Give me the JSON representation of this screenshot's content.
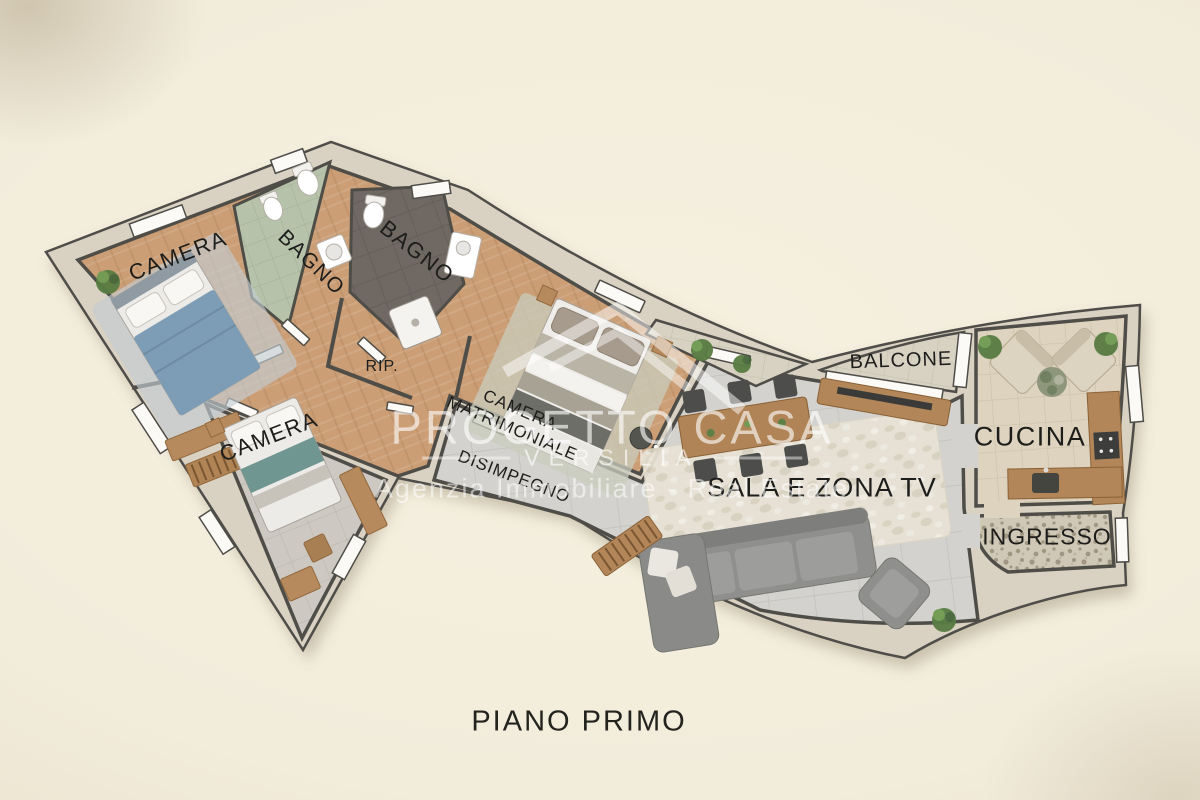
{
  "title": "PIANO PRIMO",
  "watermark": {
    "brand": "PROGETTO CASA",
    "brand_sub": "VERSILIA",
    "tagline": "Agenzia Immobiliare - Real Estate",
    "logo": "house-roof-icon"
  },
  "rooms": [
    {
      "id": "camera-1",
      "label": "CAMERA"
    },
    {
      "id": "bagno-1",
      "label": "BAGNO"
    },
    {
      "id": "bagno-2",
      "label": "BAGNO"
    },
    {
      "id": "ripostiglio",
      "label": "RIP."
    },
    {
      "id": "camera-2",
      "label": "CAMERA"
    },
    {
      "id": "camera-matrimoniale",
      "label": "CAMERA MATRIMONIALE",
      "line1": "CAMERA",
      "line2": "MATRIMONIALE"
    },
    {
      "id": "disimpegno",
      "label": "DISIMPEGNO"
    },
    {
      "id": "sala",
      "label": "SALA E ZONA TV"
    },
    {
      "id": "balcone",
      "label": "BALCONE"
    },
    {
      "id": "cucina",
      "label": "CUCINA"
    },
    {
      "id": "ingresso",
      "label": "INGRESSO"
    }
  ],
  "colors": {
    "background": "#f2ecdb",
    "wall_line": "#4f4d48",
    "wall_band": "#d9d2c2",
    "wood_floor": "#cb9e75",
    "sala_tile": "#d3d2ce",
    "cucina_tile": "#ded3bf",
    "balcone_tile": "#d8d2c3",
    "bagno_green": "#b6c2aa",
    "bagno_dark": "#6f6863",
    "ingresso_terrazzo": "#cfc8b6",
    "label_text": "#1d1d1b",
    "watermark_text": "#ffffff"
  }
}
